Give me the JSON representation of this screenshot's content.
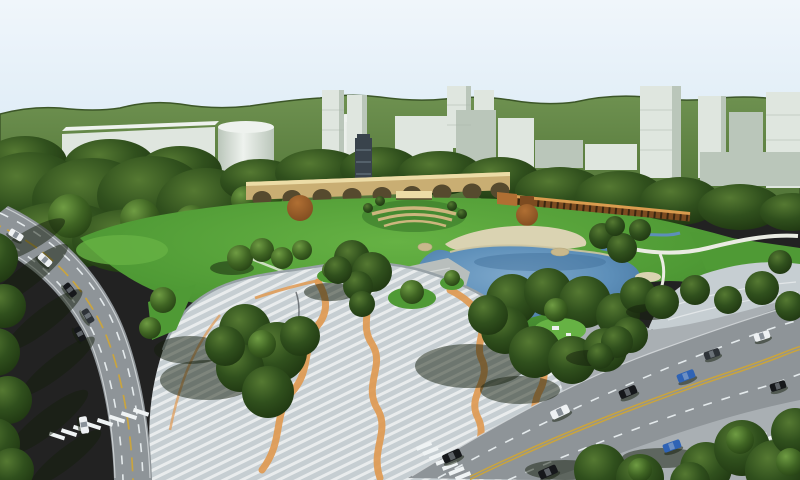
{
  "scene": {
    "description": "Aerial 3D rendering of an urban park master plan: central great lawn and lake with sand beach, boulders and stone terrace; striped pedestrian plaza crossed by orange ribbon paths; arched viaduct bridge, lookout tower, terraced amphitheatre and long timber pergola wall; dense tree groves; white city high-rise blocks and cylindrical tanks in front of green hills; a curved boulevard on the left and a wide diagonal avenue at lower right, both carrying car traffic with zebra crossings.",
    "features": [
      "green hills",
      "city high-rise blocks",
      "cylindrical tank buildings",
      "forest belt",
      "arched viaduct bridge",
      "lookout tower",
      "terraced amphitheatre",
      "timber pergola wall",
      "great lawn",
      "lake",
      "sand beach",
      "boulders",
      "stone terrace",
      "striped plaza",
      "orange ribbon paths",
      "curved boulevard",
      "diagonal avenue",
      "zebra crossings",
      "street traffic",
      "tree shadows"
    ],
    "counts": {
      "viaduct_arches": 9,
      "cars_left_road": 6,
      "cars_right_road": 9
    }
  },
  "traffic": {
    "left_road_cars": [
      "white",
      "white",
      "black",
      "dark-gray",
      "black",
      "white"
    ],
    "right_road_cars": [
      "white",
      "black",
      "blue",
      "dark-gray",
      "white",
      "black",
      "blue",
      "black",
      "black"
    ]
  },
  "palette": {
    "sky_top": "#f0f6fb",
    "sky_bottom": "#dcebf6",
    "hill_top": "#6e9150",
    "hill_bottom": "#4e7134",
    "hill_ridge": "#3c5628",
    "forest_hi": "#557932",
    "forest_mid": "#30501d",
    "forest_dark": "#1d3410",
    "treem_hi": "#6f9c43",
    "treem_mid": "#3f6423",
    "treem_dark": "#244013",
    "treel_hi": "#8cb85c",
    "treel_mid": "#527c2e",
    "lawn_light": "#66b244",
    "lawn": "#4f9a35",
    "lawn_dark": "#39762a",
    "lake_light": "#7fa9cc",
    "lake": "#5d8fb9",
    "lake_deep": "#416f9a",
    "water_line": "#cfc7a2",
    "sand": "#dad3b2",
    "sand_dark": "#b3a87e",
    "rock": "#c9b88c",
    "stone": "#b8bebc",
    "stone_line": "#d9dddb",
    "pavement": "#a9afb3",
    "plaza": "#c6ced2",
    "plaza_stripe": "#e9eced",
    "plaza_curb": "#97a1a6",
    "ribbon": "#e09a52",
    "road": "#8e9498",
    "road_edge": "#d8dcdf",
    "lane_white": "#e9eef0",
    "lane_yellow": "#c9a43e",
    "zebra": "#eff3f4",
    "bld_face": "#dfe6df",
    "bld_side": "#bac6ba",
    "bld_top": "#eef2ee",
    "bld_line": "#aab8aa",
    "viaduct": "#c9ae73",
    "viaduct_light": "#ecdca6",
    "arch": "#564a2e",
    "tower": "#39434c",
    "tower_line": "#8899a5",
    "wood": "#7c4b20",
    "wood_light": "#d99c4f",
    "wood_dark": "#3a2710",
    "rust_hi": "#b06f33",
    "rust_mid": "#7e4a1f",
    "terrace_tan": "#cdb67e",
    "path_white": "#eaece3",
    "shadow": "rgba(20,30,12,0.5)",
    "car_black": "#16181b",
    "car_white": "#eef1f3",
    "car_blue": "#2f63b5",
    "car_dark": "#2e3338"
  }
}
